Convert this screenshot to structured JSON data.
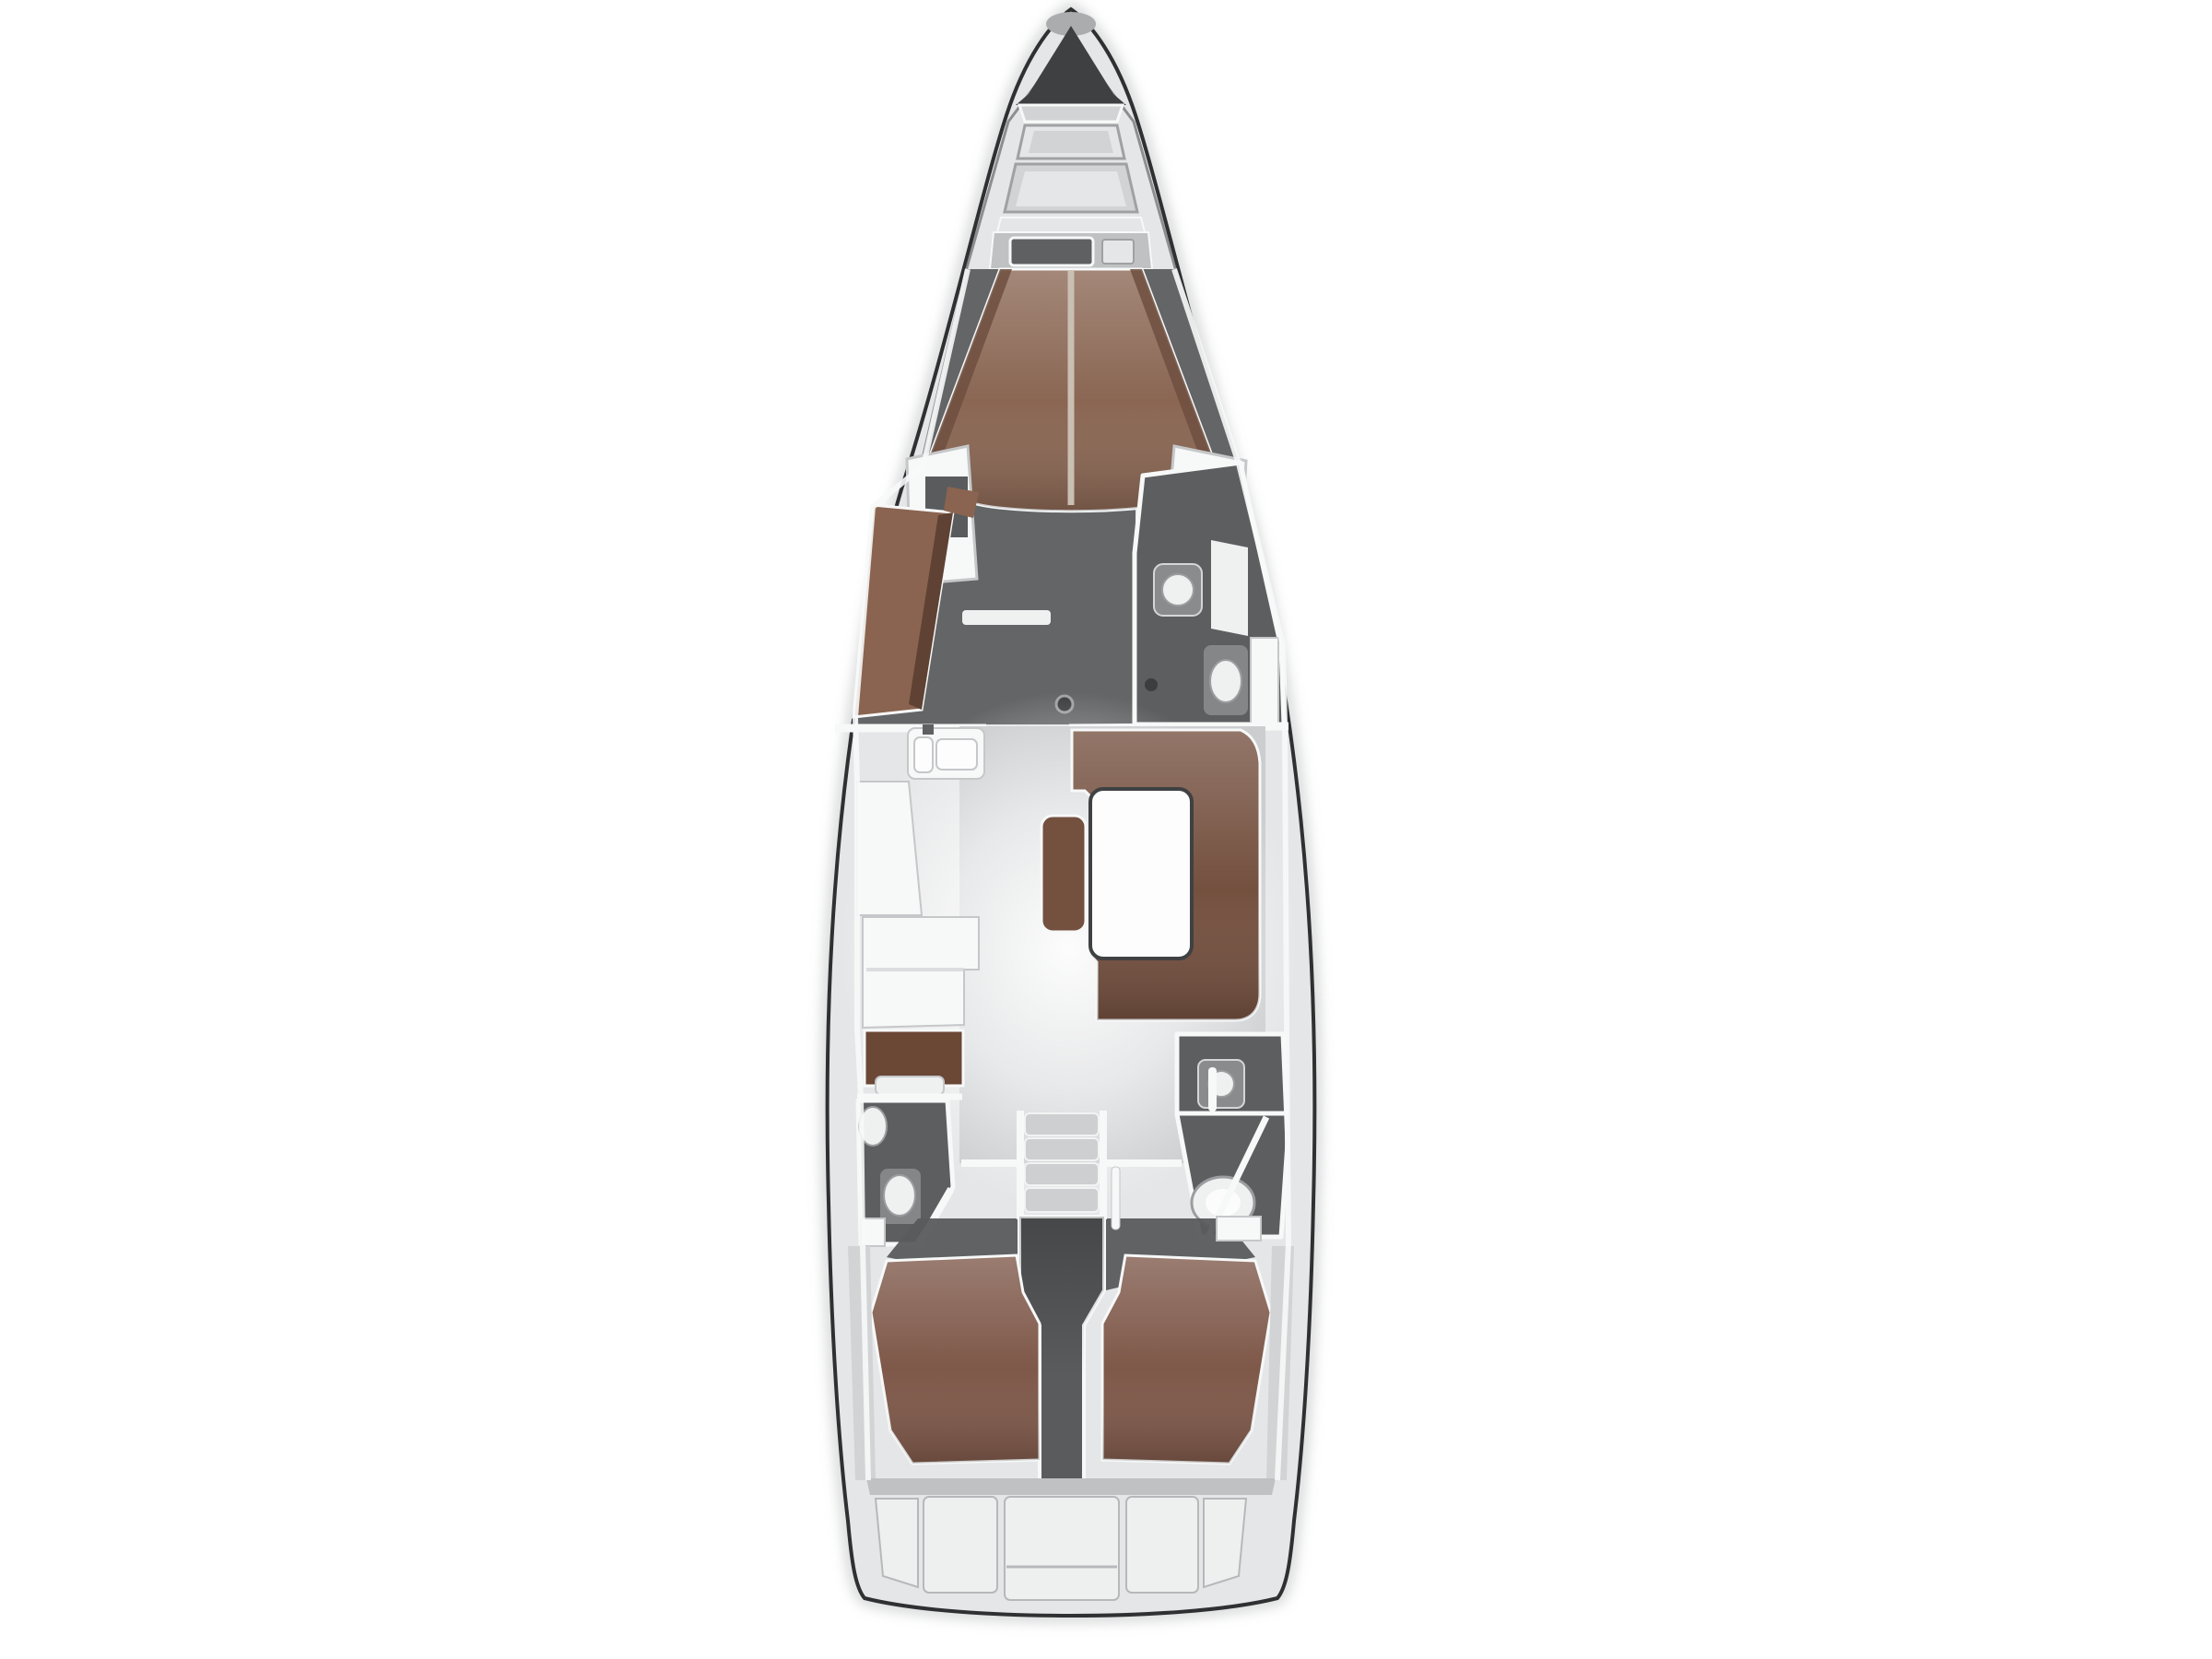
{
  "plan": {
    "title": "sailing-yacht-deck-plan-top-view",
    "colors": {
      "background": "#ffffff",
      "hull_line": "#2e3032",
      "hull_shadow": "#a8aaac",
      "deck": "#e5e6e7",
      "deck_band": "#d2d3d5",
      "deck_dark": "#bfc1c3",
      "wall": "#f7f8f8",
      "wall_edge": "#c5c7c9",
      "anchor_locker": "#3e4042",
      "bow_tip_cap": "#aaacae",
      "hatch_frame": "#9fa1a3",
      "hatch_dark": "#5e6062",
      "cabin_floor": "#636567",
      "head_floor": "#5c5e60",
      "fixture": "#898b8d",
      "fixture_edge": "#d5d6d8",
      "porcelain": "#eff0f0",
      "porcelain_edge": "#9b9da0",
      "vberth_wood": "#8a6653",
      "vberth_wood_dark": "#6e4f3f",
      "wardrobe_wood": "#8a6450",
      "wardrobe_edge": "#5f4233",
      "settee_wood": "#74503f",
      "nav_wood": "#6b4736",
      "aft_bed_wood": "#7e5849",
      "table": "#fdfdfd",
      "table_line": "#3f4143",
      "salon_floor": "#cbcdcf",
      "steps": "#cdcfd1",
      "steps_edge": "#f2f3f3",
      "engine": "#595b5d",
      "transom_panel": "#eef0f0",
      "transom_edge": "#b6b8ba",
      "seam": "#c9bfb2",
      "mast": "#3b3d3f",
      "rail": "#6e7072"
    }
  }
}
